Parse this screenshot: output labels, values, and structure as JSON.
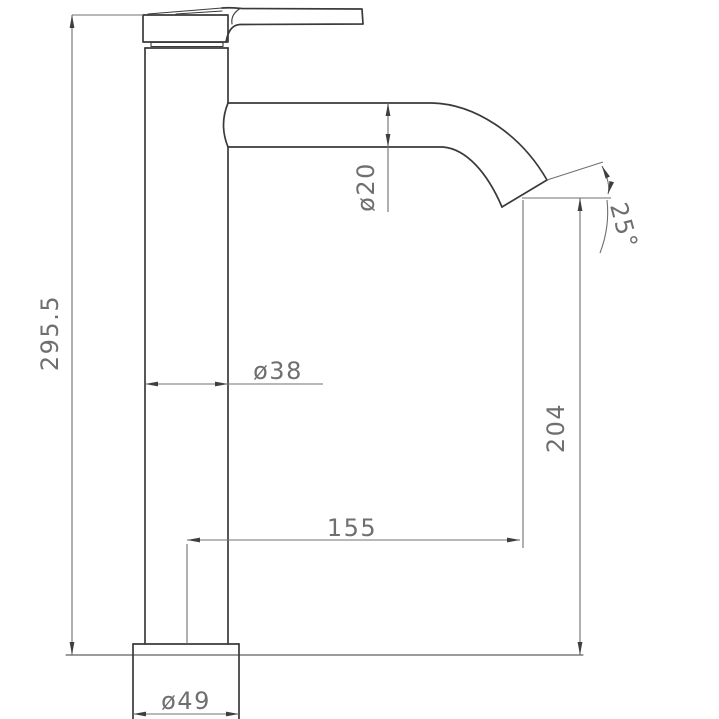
{
  "drawing": {
    "background_color": "#ffffff",
    "outline_color": "#3a3a3a",
    "dimension_color": "#707070",
    "dimensions": {
      "overall_height": "295.5",
      "spout_diameter": "ø20",
      "spout_angle": "25°",
      "body_diameter": "ø38",
      "outlet_height": "204",
      "spout_reach": "155",
      "base_diameter": "ø49"
    }
  }
}
